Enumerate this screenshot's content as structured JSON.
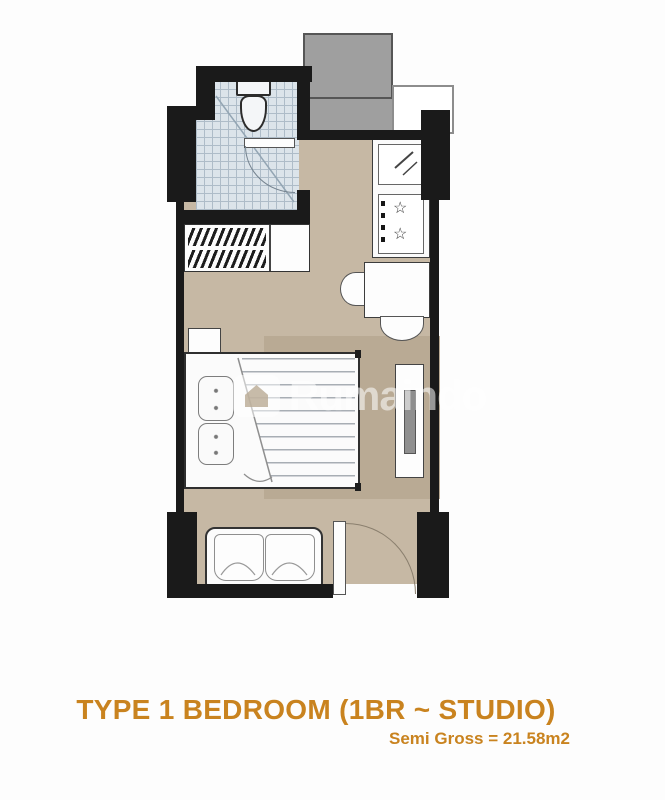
{
  "title": {
    "line1": "TYPE 1 BEDROOM (1BR ~ STUDIO)",
    "line2": "Semi Gross = 21.58m2"
  },
  "watermark": {
    "text": "Rumaindo"
  },
  "glyphs": {
    "burner": "☆"
  },
  "colors": {
    "accent_orange": "#c9831f",
    "wall": "#1a1a1a",
    "floor": "#c6b8a4",
    "rug": "#b9aa94",
    "corridor": "#9f9f9f",
    "bath_tile": "#dce4ea"
  }
}
